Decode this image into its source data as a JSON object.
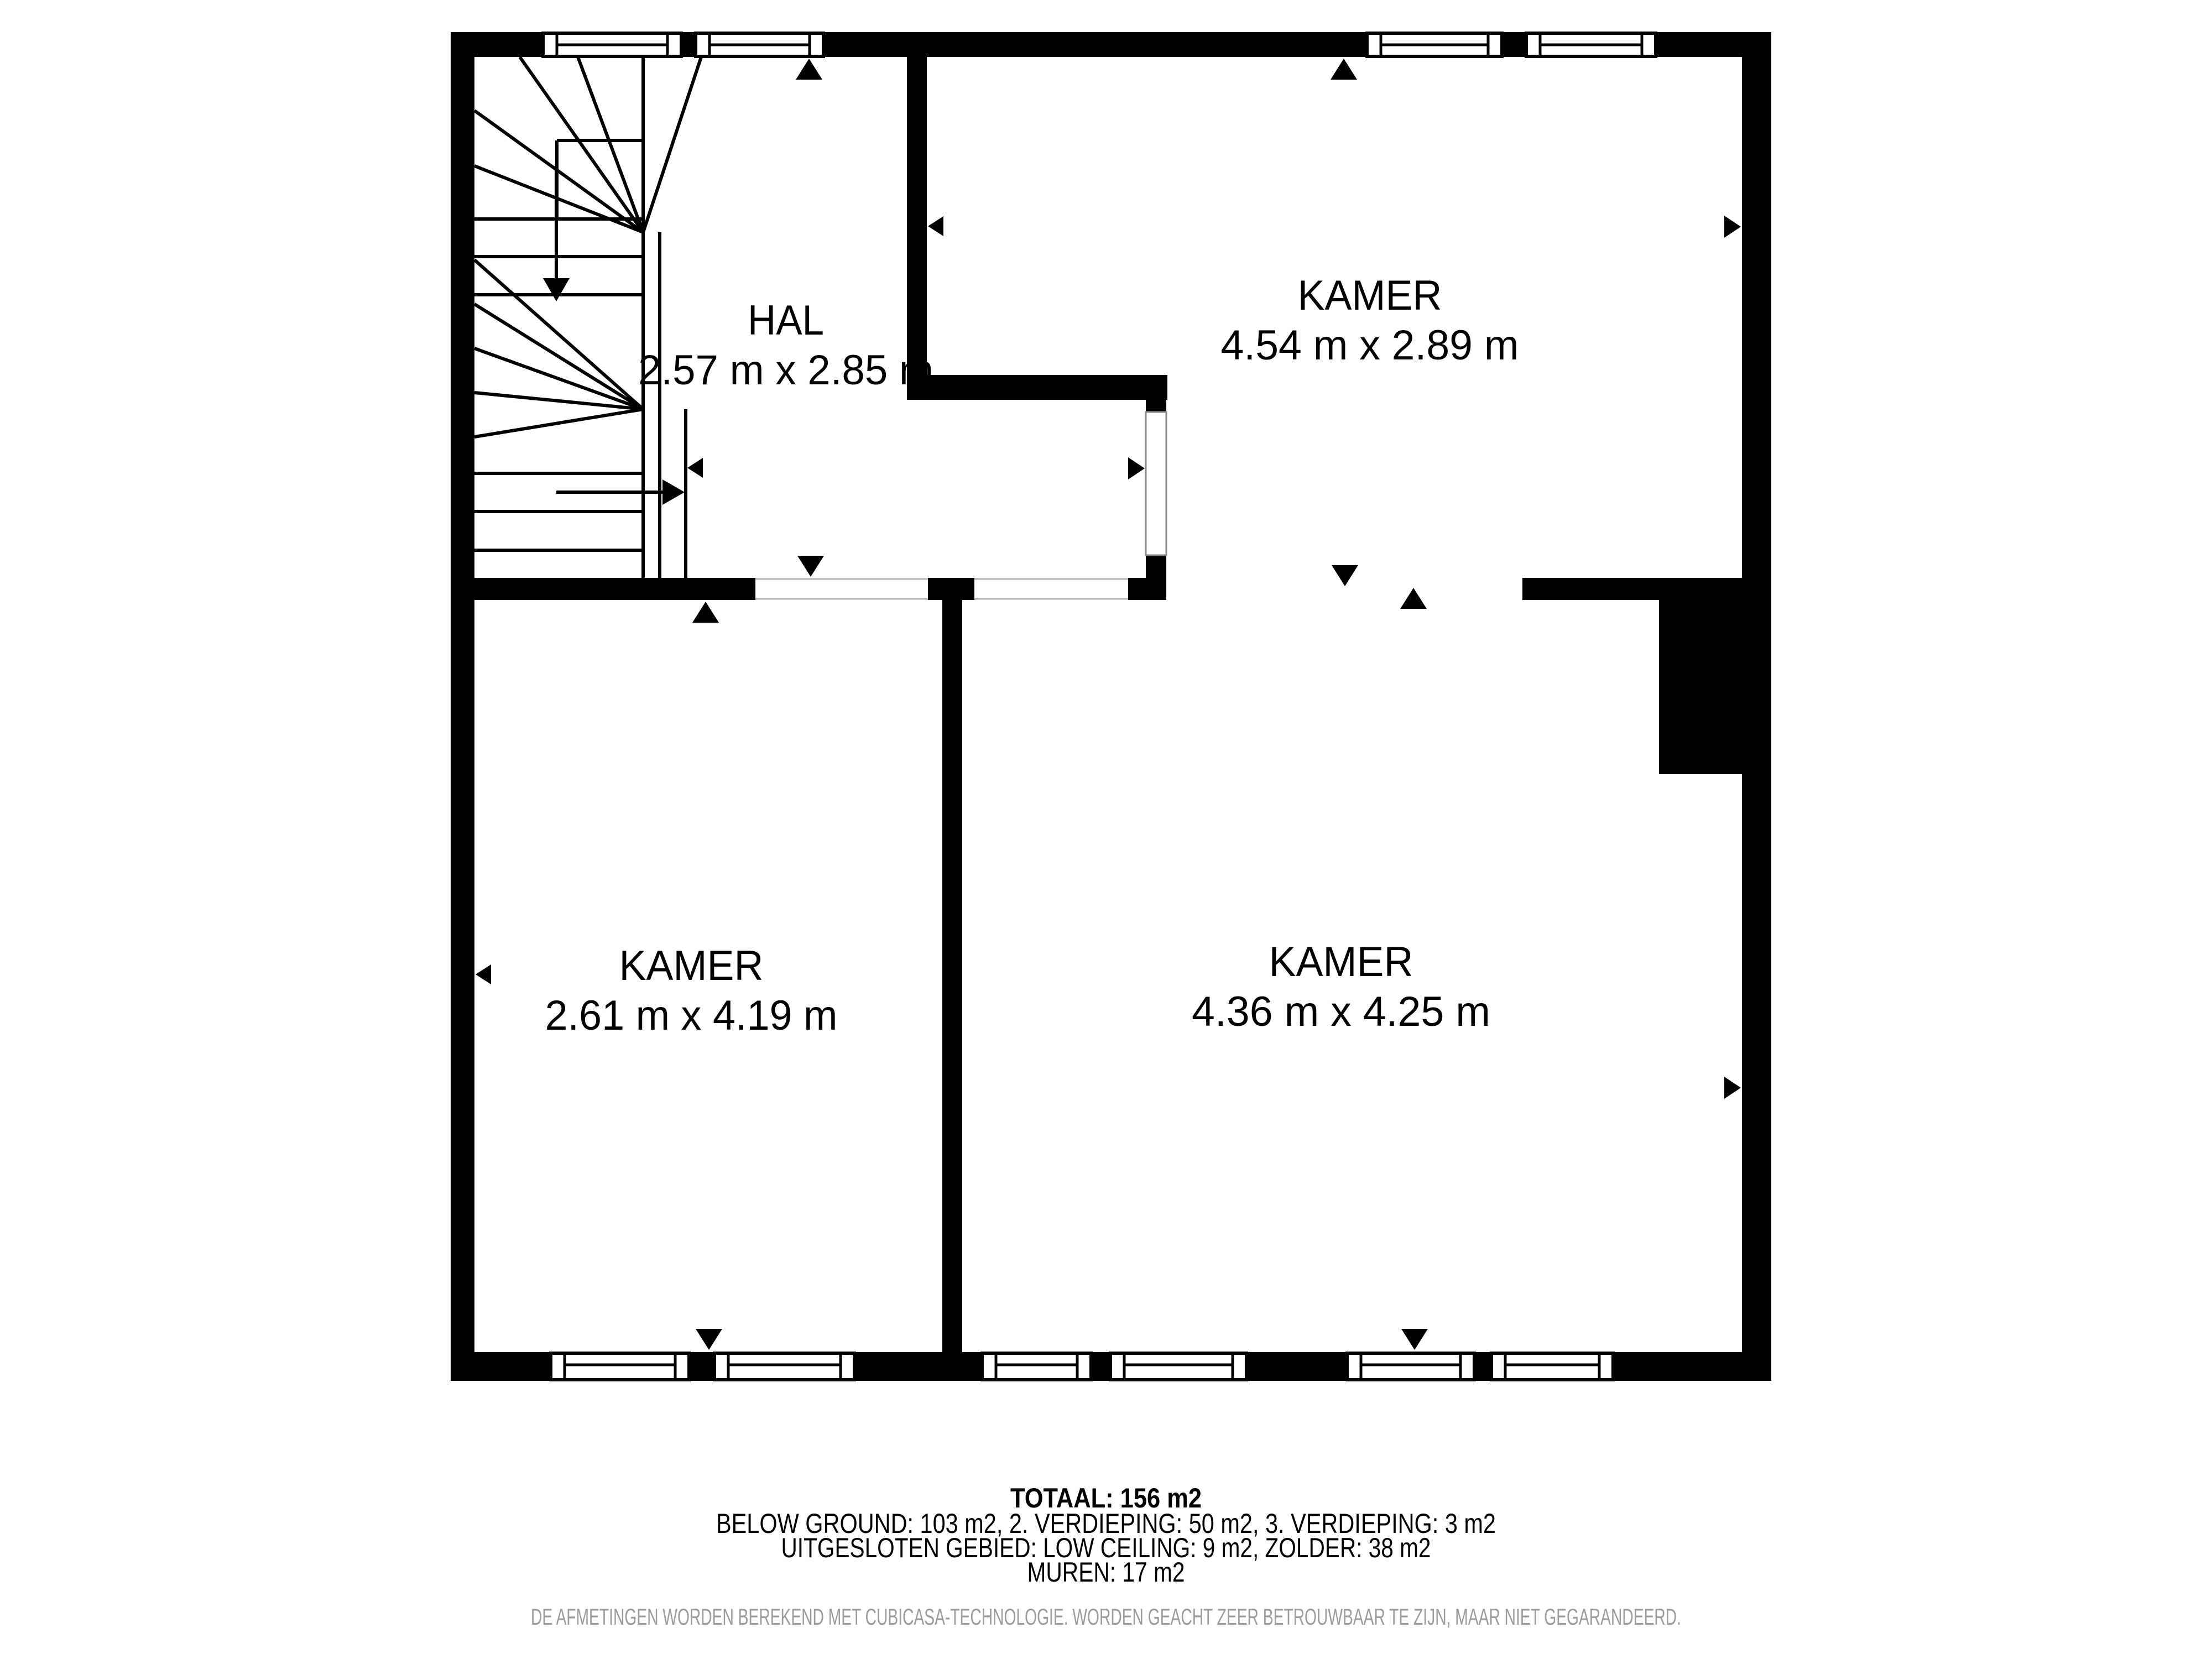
{
  "plan": {
    "rooms": [
      {
        "name": "HAL",
        "dims": "2.57 m x 2.85 m"
      },
      {
        "name": "KAMER",
        "dims": "4.54 m x 2.89 m"
      },
      {
        "name": "KAMER",
        "dims": "2.61 m x 4.19 m"
      },
      {
        "name": "KAMER",
        "dims": "4.36 m x 4.25 m"
      }
    ]
  },
  "footer": {
    "total": "TOTAAL: 156 m2",
    "areas_line1": "BELOW GROUND: 103 m2, 2. VERDIEPING: 50 m2, 3. VERDIEPING: 3 m2",
    "areas_line2": "UITGESLOTEN GEBIED: LOW CEILING: 9 m2, ZOLDER: 38 m2",
    "walls_line": "MUREN: 17 m2",
    "disclaimer": "DE AFMETINGEN WORDEN BEREKEND MET CUBICASA-TECHNOLOGIE. WORDEN GEACHT ZEER BETROUWBAAR TE ZIJN, MAAR NIET GEGARANDEERD."
  },
  "colors": {
    "wall": "#000000",
    "text": "#000000",
    "disclaimer_text": "#9b9b9b",
    "background": "#ffffff",
    "opening_outline": "#b4b4b4"
  }
}
